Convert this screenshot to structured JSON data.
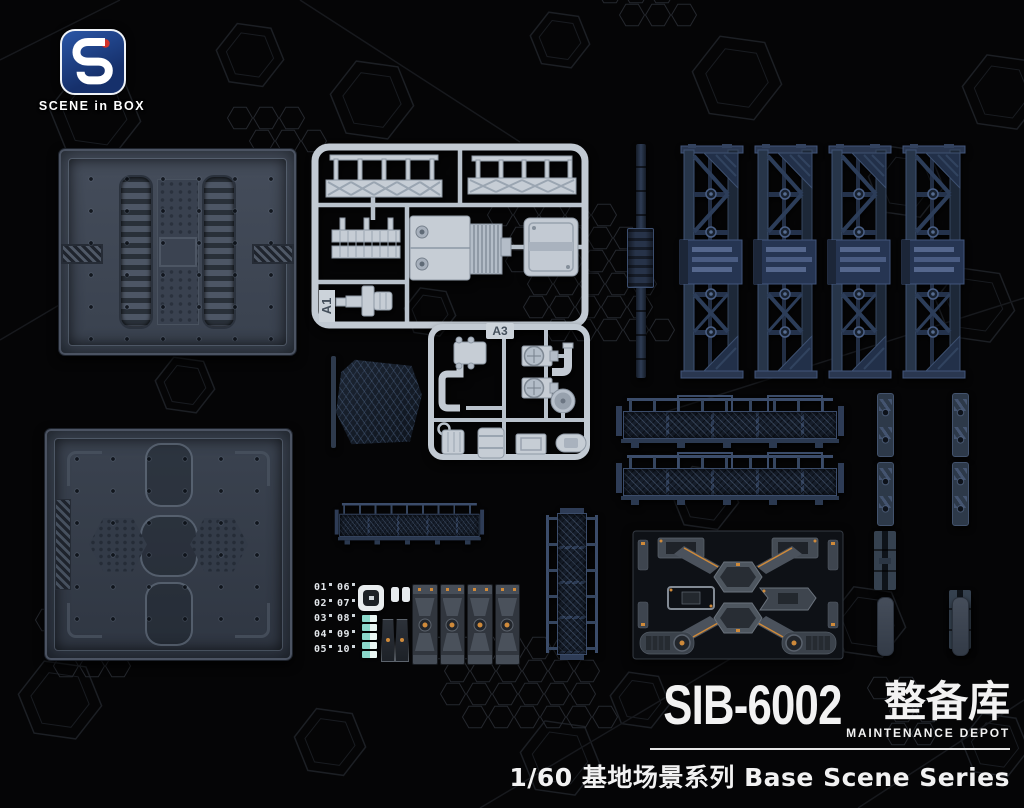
{
  "brand": {
    "name": "SCENE in BOX",
    "logo_colors": {
      "square": "#1d3f7e",
      "dot": "#d23229",
      "glyph": "#ffffff"
    }
  },
  "sprues": {
    "a1_label": "A1",
    "a3_label": "A3"
  },
  "decal_sheet": {
    "numbers_left": [
      "01",
      "02",
      "03",
      "04",
      "05"
    ],
    "numbers_right": [
      "06",
      "07",
      "08",
      "09",
      "10"
    ]
  },
  "title": {
    "model_number": "SIB-6002",
    "name_cn": "整备库",
    "name_en": "MAINTENANCE DEPOT",
    "series": "1/60 基地场景系列 Base Scene Series"
  },
  "colors": {
    "background": "#050506",
    "pattern_line": "#1c1f24",
    "plate_gray": "#3d4553",
    "sprue_light": "#c6cdd5",
    "navy_part": "#1f2a3b",
    "accent_orange": "#cf8a3a",
    "teal_decal": "#8ad7ca",
    "text_white": "#f2f2f2"
  }
}
